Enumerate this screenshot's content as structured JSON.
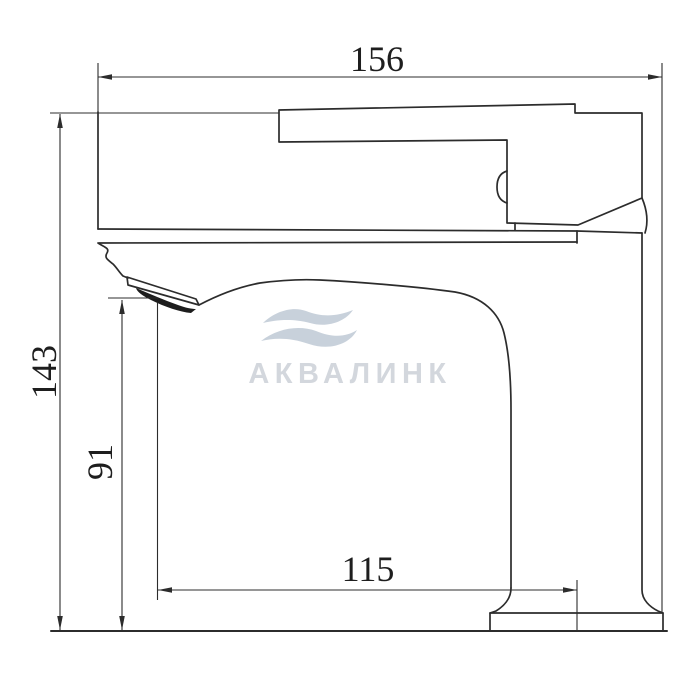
{
  "watermark": {
    "brand": "АКВАЛИНК",
    "logo": "wave-icon",
    "logo_color": "#c8d1db",
    "text_color": "#d3d7dd"
  },
  "dimensions": {
    "overall_width": {
      "value": "156",
      "orientation": "horizontal",
      "position": "top"
    },
    "overall_height": {
      "value": "143",
      "orientation": "vertical",
      "position": "left"
    },
    "spout_height": {
      "value": "91",
      "orientation": "vertical",
      "position": "left-inner"
    },
    "spout_reach": {
      "value": "115",
      "orientation": "horizontal",
      "position": "bottom"
    }
  },
  "drawing": {
    "subject": "single-lever basin faucet side view",
    "line_color": "#2c2c2c",
    "background_color": "#ffffff",
    "aerator_color": "#1d1d1d"
  }
}
